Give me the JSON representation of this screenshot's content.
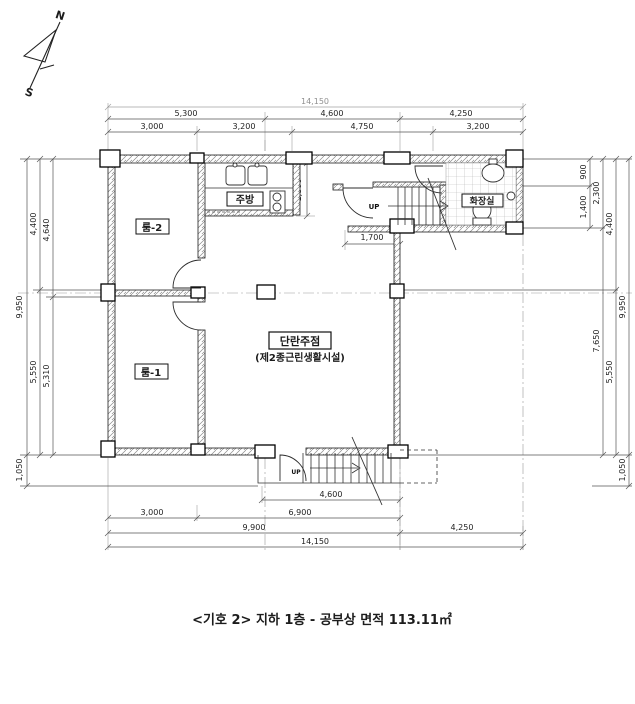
{
  "compass": {
    "north": "N",
    "south": "S"
  },
  "dims": {
    "top_overall": "14,150",
    "top_mid": [
      "5,300",
      "4,600",
      "4,250"
    ],
    "top_inner": [
      "3,000",
      "3,200",
      "4,750",
      "3,200"
    ],
    "left": {
      "overall": "9,950",
      "mid": [
        "4,400",
        "5,550"
      ],
      "inner": [
        "4,640",
        "5,310"
      ],
      "below": "1,050"
    },
    "right": {
      "overall": "9,950",
      "inner": [
        "900",
        "1,400",
        "7,650"
      ],
      "mid": "2,300",
      "outer": [
        "4,400",
        "5,550"
      ],
      "below": "1,050"
    },
    "bottom": {
      "stair": "4,600",
      "inner": [
        "3,000",
        "6,900"
      ],
      "mid": [
        "9,900",
        "4,250"
      ],
      "overall": "14,150"
    },
    "interior": {
      "kitchen_depth": "1,800",
      "entry_width": "1,700"
    }
  },
  "labels": {
    "room2": "룸-2",
    "room1": "룸-1",
    "kitchen": "주방",
    "bathroom": "화장실",
    "hall_name": "단란주점",
    "hall_use": "(제2종근린생활시설)",
    "up_stair": "UP",
    "up_entrance": "UP"
  },
  "caption": "<기호 2> 지하 1층 - 공부상 면적 113.11㎡",
  "colors": {
    "paper": "#ffffff",
    "ink": "#1c1c1c",
    "dim_line": "#555555"
  }
}
